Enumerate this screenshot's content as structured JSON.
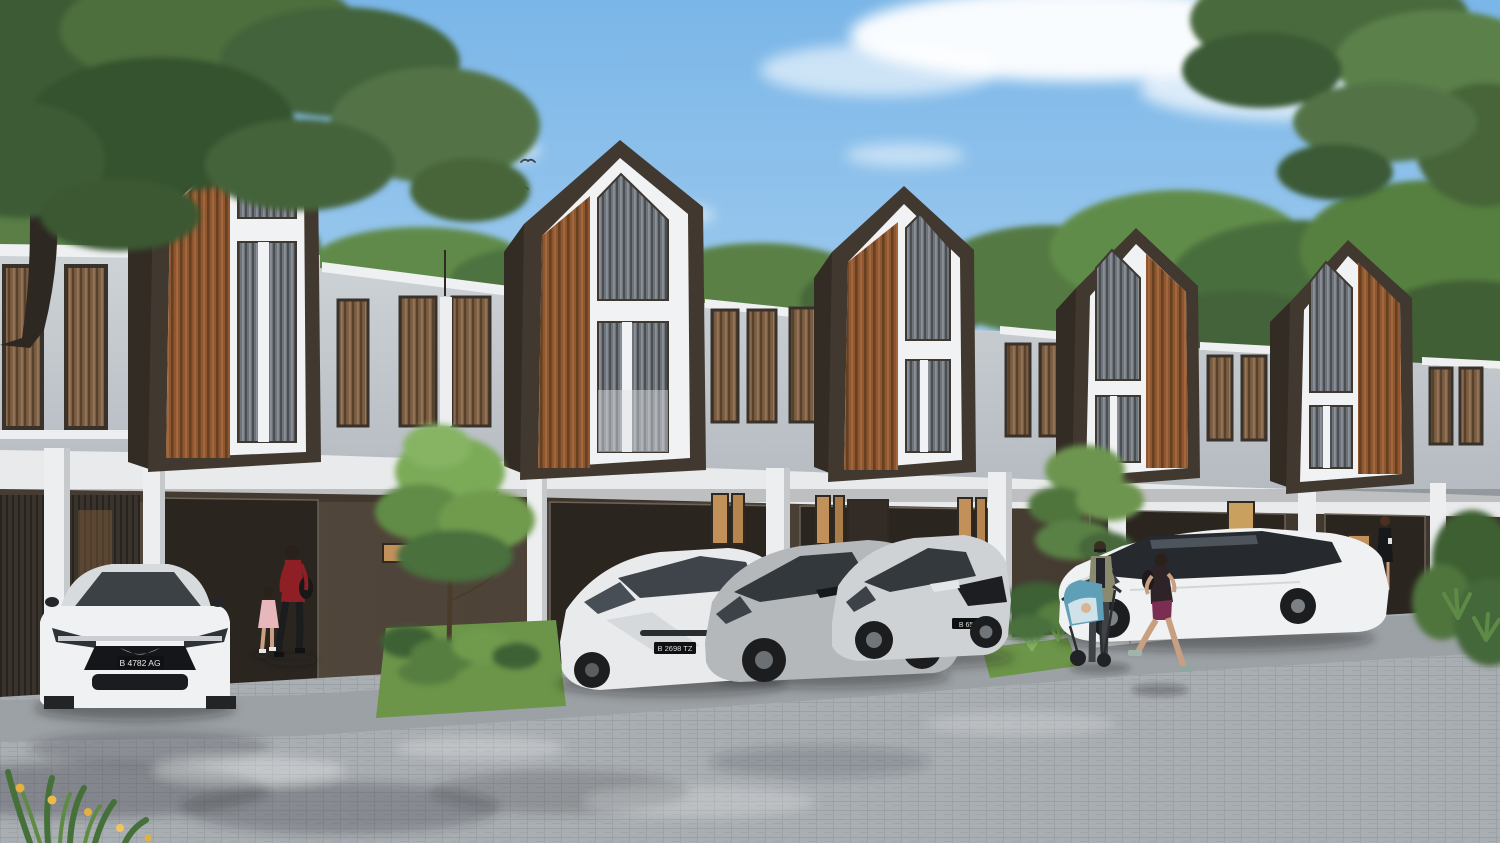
{
  "meta": {
    "title": "Modern townhouse row - architectural rendering",
    "view": "exterior street view, daytime"
  },
  "scene": {
    "houses": {
      "count": 5,
      "storeys": 2,
      "facade": "steep dark-brown gable frames with vertical wood slat cladding and tall white-trimmed windows",
      "ground_floor": "dark brown walls with open garages, warm lit windows and white columns"
    },
    "sky": {
      "description": "clear blue sky with soft clouds",
      "birds_count": 9
    },
    "street": {
      "surface": "grey paver blocks",
      "features": [
        "driveway aprons",
        "white curb stones",
        "planting beds",
        "young trees"
      ]
    }
  },
  "colors": {
    "sky_top": "#7ab6e8",
    "sky_horizon": "#e9f3fa",
    "cloud": "#ffffff",
    "roof_frame_brown": "#41382f",
    "roof_side_brown": "#332c25",
    "wood_slat": "#8f5731",
    "upper_wall_grey": "#c9ced3",
    "trim_white": "#f1f2f3",
    "floor_band": "#e8eaeb",
    "ground_wall_brown": "#4d4238",
    "garage_shadow": "#2b2520",
    "window_glass_grey": "#6e7379",
    "curtain_brown": "#7c5e42",
    "paving_grey": "#a9aeb2",
    "grass_green": "#6c9549",
    "foliage_green": "#547940",
    "warm_window_light": "#c2915a"
  },
  "cars": [
    {
      "id": "car-1",
      "type": "white sedan, front view",
      "plate": "B 4782 AG"
    },
    {
      "id": "car-2",
      "type": "white hatchback, angled",
      "plate": "B 2698 TZ"
    },
    {
      "id": "car-3",
      "type": "grey compact crossover",
      "plate": "B 1454 AJ"
    },
    {
      "id": "car-4",
      "type": "silver crossover",
      "plate": "B 6505 T"
    },
    {
      "id": "car-5",
      "type": "white hatchback, side view",
      "plate": ""
    }
  ],
  "people": [
    {
      "id": "person-1",
      "description": "woman in red top and black trousers with shoulder bag, walking"
    },
    {
      "id": "person-2",
      "description": "little girl in pink dress"
    },
    {
      "id": "person-3",
      "description": "woman in olive jacket pushing a blue stroller"
    },
    {
      "id": "person-4",
      "description": "female jogger in dark top and plum shorts"
    },
    {
      "id": "person-5",
      "description": "woman in black dress standing at an entrance"
    }
  ]
}
